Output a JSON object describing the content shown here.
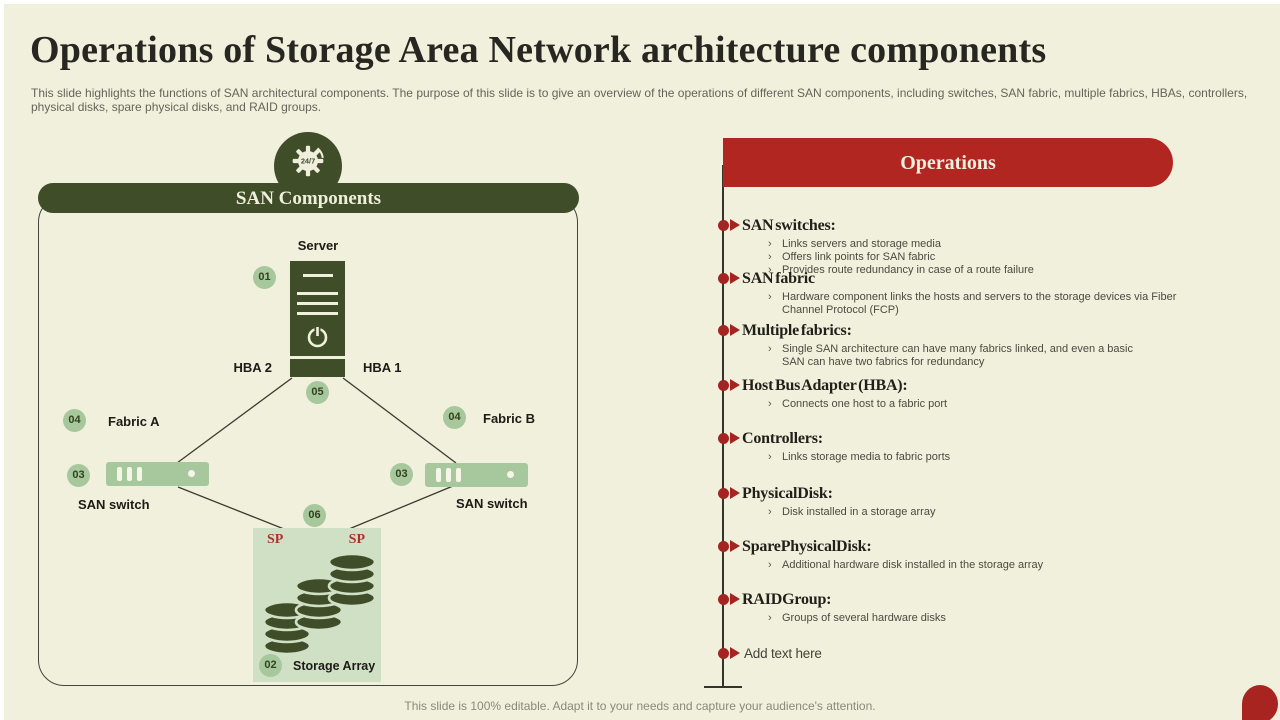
{
  "slide": {
    "title": "Operations of Storage Area Network architecture components",
    "subtitle": "This slide highlights the functions of SAN architectural components. The purpose of this slide is to give an overview of the operations of different SAN  components, including switches, SAN fabric, multiple fabrics, HBAs, controllers, physical disks, spare physical disks, and RAID groups.",
    "footer": "This slide is 100% editable. Adapt it to your needs and capture your audience's attention."
  },
  "colors": {
    "background": "#f1f0dc",
    "dark_green": "#3f4e29",
    "light_green": "#a7c79c",
    "pale_green": "#d0e0c5",
    "accent_red": "#b22622",
    "bullet_red": "#a32421"
  },
  "diagram": {
    "header": "SAN Components",
    "icon": "gear-24-7-icon",
    "icon_text": "24/7",
    "nodes": {
      "server_label": "Server",
      "hba_left": "HBA 2",
      "hba_right": "HBA 1",
      "fabric_left": "Fabric A",
      "fabric_right": "Fabric B",
      "switch_left_label": "SAN switch",
      "switch_right_label": "SAN switch",
      "storage_label": "Storage Array",
      "sp_left": "SP",
      "sp_right": "SP"
    },
    "badges": {
      "server": "01",
      "storage": "02",
      "switch_left": "03",
      "switch_right": "03",
      "fabric_left": "04",
      "fabric_right": "04",
      "hba": "05",
      "link": "06"
    }
  },
  "operations": {
    "header": "Operations",
    "sub_bullet_glyph": "›",
    "items": [
      {
        "title": "SAN switches:",
        "points": [
          "Links servers and storage media",
          "Offers link points for SAN fabric",
          "Provides route redundancy in case of a route failure"
        ]
      },
      {
        "title": "SAN fabric",
        "points": [
          "Hardware component links the hosts and servers to the storage devices via Fiber Channel Protocol (FCP)"
        ]
      },
      {
        "title": "Multiple fabrics:",
        "points": [
          "Single SAN architecture can have many fabrics linked, and even a basic SAN can have two fabrics for redundancy"
        ]
      },
      {
        "title": "Host Bus Adapter (HBA):",
        "points": [
          "Connects one host to a fabric port"
        ]
      },
      {
        "title": "Controllers:",
        "points": [
          "Links storage media to fabric ports"
        ]
      },
      {
        "title": "PhysicalDisk:",
        "points": [
          "Disk installed in a storage array"
        ]
      },
      {
        "title": "SparePhysicalDisk:",
        "points": [
          "Additional hardware disk installed in the storage array"
        ]
      },
      {
        "title": "RAIDGroup:",
        "points": [
          "Groups of several hardware disks"
        ]
      },
      {
        "title": "Add text here",
        "points": []
      }
    ]
  }
}
